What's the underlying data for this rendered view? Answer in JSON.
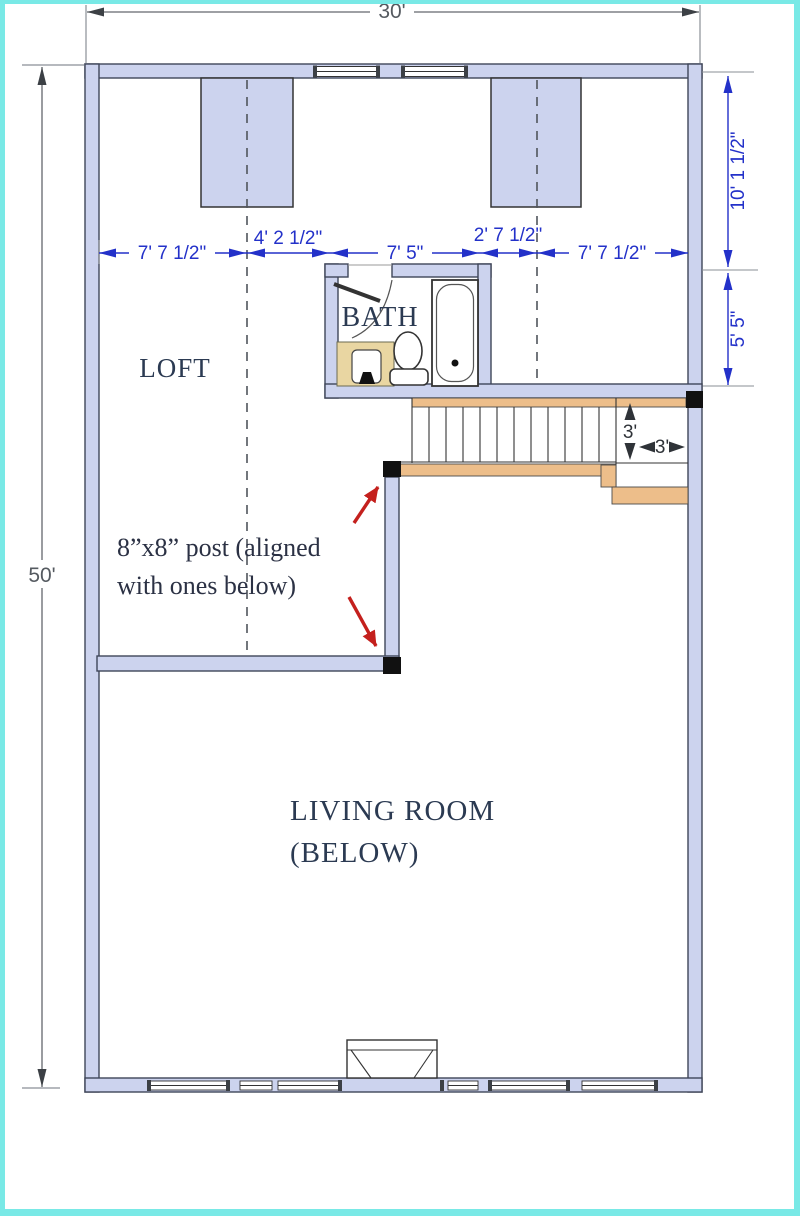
{
  "plan": {
    "labels": {
      "loft": "LOFT",
      "bath": "BATH",
      "living_line1": "LIVING ROOM",
      "living_line2": "(BELOW)"
    },
    "dimensions": {
      "overall_width": "30'",
      "overall_height": "50'",
      "right_upper": "10' 1 1/2\"",
      "right_lower": "5' 5\"",
      "row": [
        "7' 7 1/2\"",
        "4' 2 1/2\"",
        "7' 5\"",
        "2' 7 1/2\"",
        "7' 7 1/2\""
      ],
      "stair_run_depth": "3'",
      "stair_landing_width": "3'"
    },
    "annotation": {
      "line1": "8”x8” post (aligned",
      "line2": "with ones below)"
    },
    "colors": {
      "wall_fill": "#ccd3ee",
      "dimension_blue": "#2331c9",
      "stair_tan": "#edbe8a",
      "vanity_tan": "#e9d6a2",
      "annotation_red": "#c4201d",
      "label_navy": "#2b3a52",
      "frame_cyan": "#79e9e6"
    }
  }
}
